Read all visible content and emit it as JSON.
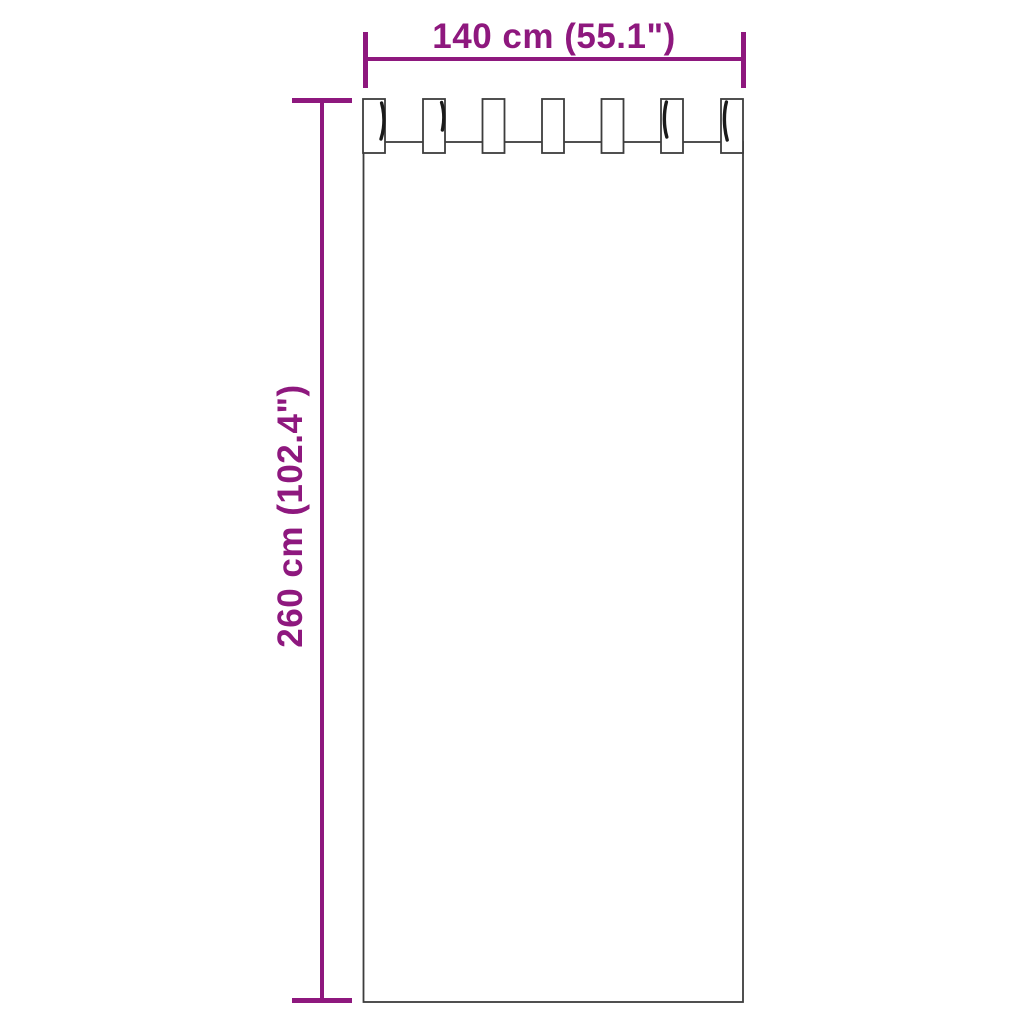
{
  "diagram": {
    "product": "tab-top-curtain",
    "width_label": "140 cm (55.1\")",
    "height_label": "260 cm (102.4\")",
    "tab_count": 7,
    "colors": {
      "dimension": "#8E187E",
      "outline": "#3D3D3D",
      "shading": "#1A1A1A",
      "background": "#FFFFFF"
    }
  }
}
